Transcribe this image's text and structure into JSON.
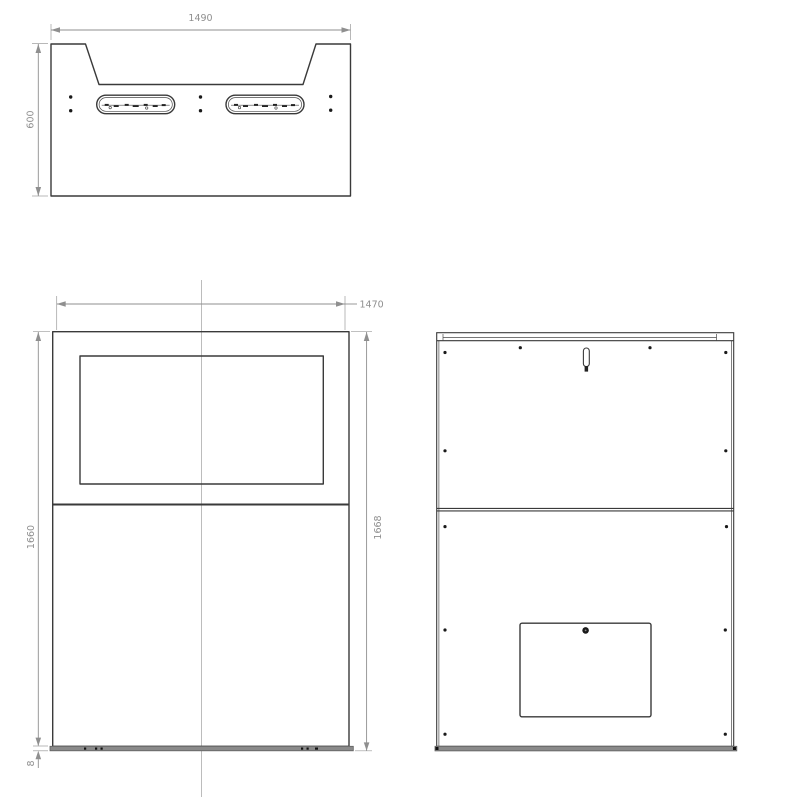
{
  "drawing": {
    "colors": {
      "background": "#ffffff",
      "outline": "#3a3a3a",
      "dimension": "#8f8f8f",
      "centerline": "#bcbcbc",
      "base_plate_fill": "#8a8a8a"
    },
    "top_view": {
      "dims": {
        "width": "1490",
        "depth": "600"
      }
    },
    "front_view": {
      "dims": {
        "width": "1470",
        "height_left": "1660",
        "height_right": "1668",
        "base_thickness": "8"
      }
    },
    "back_view": {
      "dims": {}
    }
  }
}
